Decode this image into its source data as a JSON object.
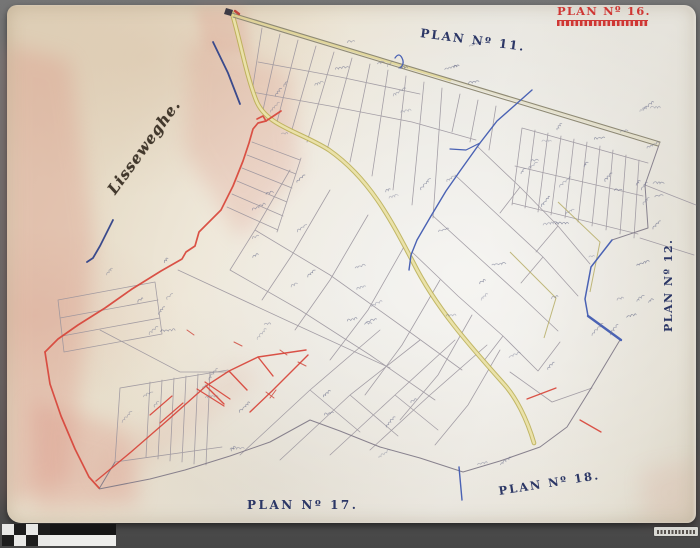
{
  "photo": {
    "description_labels": {
      "plan16": {
        "text": "PLAN Nº 16.",
        "color": "#cf3734"
      },
      "plan11": {
        "text": "PLAN Nº 11.",
        "color": "#2c3766"
      },
      "plan12": {
        "text": "PLAN Nº 12.",
        "color": "#2c3766"
      },
      "plan17": {
        "text": "PLAN Nº 17.",
        "color": "#2c3766"
      },
      "plan18": {
        "text": "PLAN Nº 18.",
        "color": "#2c3766"
      },
      "village": {
        "text": "Lisseweghe.",
        "color": "#42382c"
      }
    },
    "map_colors": {
      "paper": "#e8e0cd",
      "boundary_red": "#d8453a",
      "water_blue": "#4a62b4",
      "navy_ink": "#3a4a8c",
      "road_yellow": "#c8bc52",
      "parcel_ink": "#97919b",
      "pink_wash": "#dc8d7e"
    },
    "scale_bar": {
      "row1_cells": [
        "#e8e8e6",
        "#1d1d1d",
        "#e8e8e6",
        "#1d1d1d"
      ],
      "row1_bar": "#161616",
      "row2_cells": [
        "#1d1d1d",
        "#e8e8e6",
        "#1d1d1d",
        "#e8e8e6"
      ],
      "row2_bar": "#ededeb"
    }
  }
}
